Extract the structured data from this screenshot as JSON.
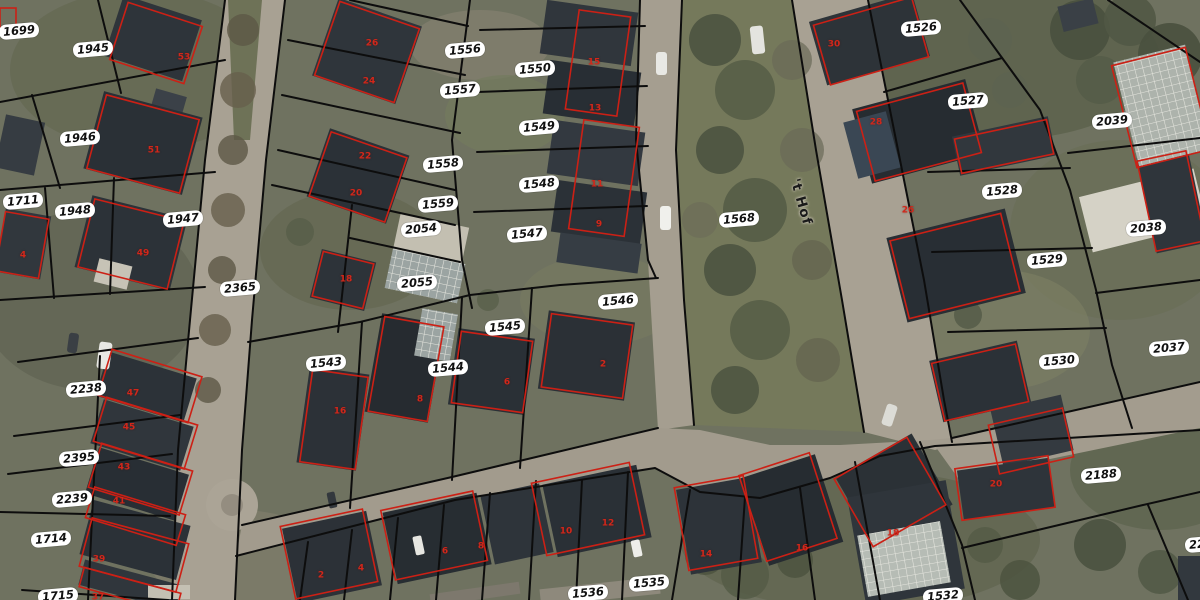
{
  "map": {
    "type": "aerial-cadastral-map",
    "street_label": "'t Hof",
    "colors": {
      "parcel_boundary": "#0d0d0d",
      "building_outline": "#cc2015",
      "label_bg": "#ffffff",
      "label_text": "#111111",
      "road": "#a8a193",
      "ground": "#6f7260"
    },
    "parcel_labels": [
      {
        "id": "1699",
        "x": 19,
        "y": 31
      },
      {
        "id": "1945",
        "x": 93,
        "y": 49
      },
      {
        "id": "1946",
        "x": 80,
        "y": 138
      },
      {
        "id": "1711",
        "x": 23,
        "y": 201
      },
      {
        "id": "1948",
        "x": 75,
        "y": 211
      },
      {
        "id": "1947",
        "x": 183,
        "y": 219
      },
      {
        "id": "2365",
        "x": 240,
        "y": 288
      },
      {
        "id": "2238",
        "x": 86,
        "y": 389
      },
      {
        "id": "2395",
        "x": 79,
        "y": 458
      },
      {
        "id": "2239",
        "x": 72,
        "y": 499
      },
      {
        "id": "1714",
        "x": 51,
        "y": 539
      },
      {
        "id": "1715",
        "x": 58,
        "y": 596
      },
      {
        "id": "1556",
        "x": 465,
        "y": 50
      },
      {
        "id": "1557",
        "x": 460,
        "y": 90
      },
      {
        "id": "1558",
        "x": 443,
        "y": 164
      },
      {
        "id": "1559",
        "x": 438,
        "y": 204
      },
      {
        "id": "2054",
        "x": 421,
        "y": 229
      },
      {
        "id": "2055",
        "x": 417,
        "y": 283
      },
      {
        "id": "1550",
        "x": 535,
        "y": 69
      },
      {
        "id": "1549",
        "x": 539,
        "y": 127
      },
      {
        "id": "1548",
        "x": 539,
        "y": 184
      },
      {
        "id": "1547",
        "x": 527,
        "y": 234
      },
      {
        "id": "1543",
        "x": 326,
        "y": 363
      },
      {
        "id": "1544",
        "x": 448,
        "y": 368
      },
      {
        "id": "1545",
        "x": 505,
        "y": 327
      },
      {
        "id": "1546",
        "x": 618,
        "y": 301
      },
      {
        "id": "1568",
        "x": 739,
        "y": 219
      },
      {
        "id": "1526",
        "x": 921,
        "y": 28
      },
      {
        "id": "1527",
        "x": 968,
        "y": 101
      },
      {
        "id": "1528",
        "x": 1002,
        "y": 191
      },
      {
        "id": "1529",
        "x": 1047,
        "y": 260
      },
      {
        "id": "1530",
        "x": 1059,
        "y": 361
      },
      {
        "id": "2039",
        "x": 1112,
        "y": 121
      },
      {
        "id": "2038",
        "x": 1146,
        "y": 228
      },
      {
        "id": "2037",
        "x": 1169,
        "y": 348
      },
      {
        "id": "2188",
        "x": 1101,
        "y": 475
      },
      {
        "id": "2244",
        "x": 1205,
        "y": 544
      },
      {
        "id": "1536",
        "x": 588,
        "y": 593
      },
      {
        "id": "1535",
        "x": 649,
        "y": 583
      },
      {
        "id": "1532",
        "x": 943,
        "y": 596
      }
    ],
    "house_numbers": [
      {
        "n": "53",
        "x": 184,
        "y": 58
      },
      {
        "n": "51",
        "x": 154,
        "y": 151
      },
      {
        "n": "49",
        "x": 143,
        "y": 254
      },
      {
        "n": "4",
        "x": 23,
        "y": 256
      },
      {
        "n": "26",
        "x": 372,
        "y": 44
      },
      {
        "n": "24",
        "x": 369,
        "y": 82
      },
      {
        "n": "22",
        "x": 365,
        "y": 157
      },
      {
        "n": "20",
        "x": 356,
        "y": 194
      },
      {
        "n": "18",
        "x": 346,
        "y": 280
      },
      {
        "n": "16",
        "x": 340,
        "y": 412
      },
      {
        "n": "8",
        "x": 420,
        "y": 400
      },
      {
        "n": "6",
        "x": 507,
        "y": 383
      },
      {
        "n": "2",
        "x": 603,
        "y": 365
      },
      {
        "n": "15",
        "x": 594,
        "y": 63
      },
      {
        "n": "13",
        "x": 595,
        "y": 109
      },
      {
        "n": "11",
        "x": 597,
        "y": 185
      },
      {
        "n": "9",
        "x": 599,
        "y": 225
      },
      {
        "n": "30",
        "x": 834,
        "y": 45
      },
      {
        "n": "28",
        "x": 876,
        "y": 123
      },
      {
        "n": "26",
        "x": 908,
        "y": 211
      },
      {
        "n": "20",
        "x": 996,
        "y": 485
      },
      {
        "n": "18",
        "x": 893,
        "y": 534
      },
      {
        "n": "16",
        "x": 802,
        "y": 549
      },
      {
        "n": "14",
        "x": 706,
        "y": 555
      },
      {
        "n": "12",
        "x": 608,
        "y": 524
      },
      {
        "n": "10",
        "x": 566,
        "y": 532
      },
      {
        "n": "8",
        "x": 481,
        "y": 547
      },
      {
        "n": "6",
        "x": 445,
        "y": 552
      },
      {
        "n": "4",
        "x": 361,
        "y": 569
      },
      {
        "n": "2",
        "x": 321,
        "y": 576
      },
      {
        "n": "47",
        "x": 133,
        "y": 394
      },
      {
        "n": "45",
        "x": 129,
        "y": 428
      },
      {
        "n": "43",
        "x": 124,
        "y": 468
      },
      {
        "n": "41",
        "x": 119,
        "y": 502
      },
      {
        "n": "39",
        "x": 99,
        "y": 560
      },
      {
        "n": "37",
        "x": 98,
        "y": 598
      }
    ]
  }
}
